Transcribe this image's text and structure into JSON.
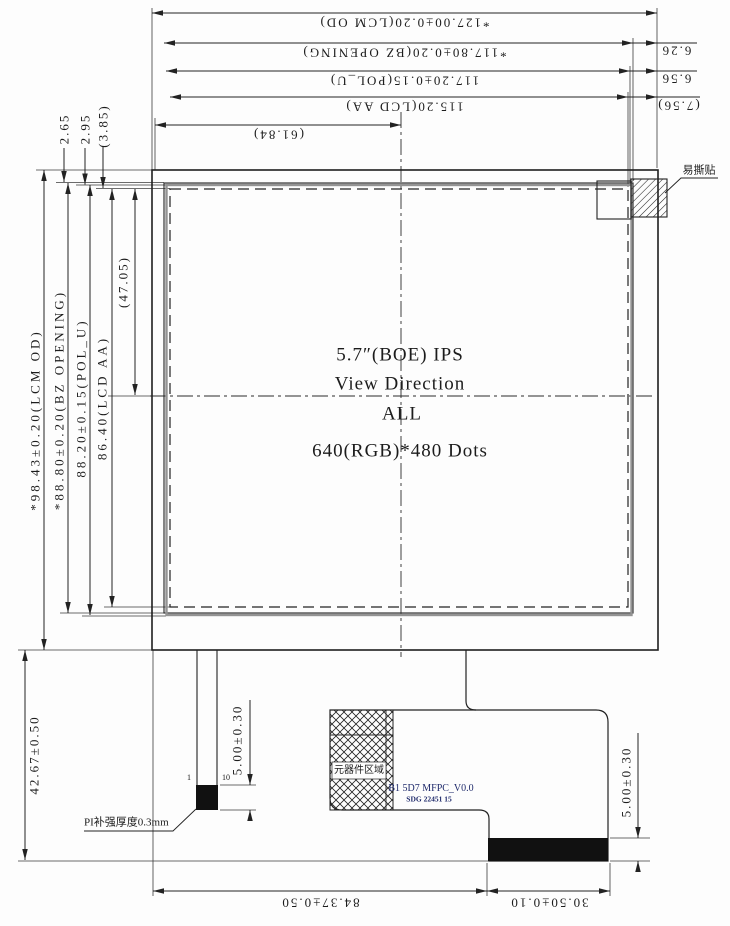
{
  "panel": {
    "size_line": "5.7″(BOE) IPS",
    "view_line": "View Direction",
    "direction": "ALL",
    "resolution": "640(RGB)*480 Dots"
  },
  "dims": {
    "top": [
      "*127.00±0.20(LCM OD)",
      "*117.80±0.20(BZ OPENING)",
      "117.20±0.15(POL_U)",
      "115.20(LCD AA)",
      "(61.84)"
    ],
    "right": [
      "6.26",
      "6.56",
      "(7.56)"
    ],
    "top_left": [
      "2.65",
      "2.95",
      "(3.85)"
    ],
    "left": [
      "*98.43±0.20(LCM OD)",
      "*88.80±0.20(BZ OPENING)",
      "88.20±0.15(POL_U)",
      "86.40(LCD AA)"
    ],
    "aa_vertical_half": "(47.05)",
    "bottom": [
      "84.37±0.50",
      "30.50±0.10"
    ],
    "module_height": "42.67±0.50",
    "pi_pad_height": "5.00±0.30",
    "fpc_pad_height": "5.00±0.30"
  },
  "annotations": {
    "tear_sticker": "易撕贴",
    "component_area": "元器件区域",
    "fpc_code": "B1 5D7 MFPC_V0.0",
    "fpc_code_sub": "SDG 22451 15",
    "pi_note": "PI补强厚度0.3mm",
    "pin_first": "1",
    "pin_last": "10"
  }
}
